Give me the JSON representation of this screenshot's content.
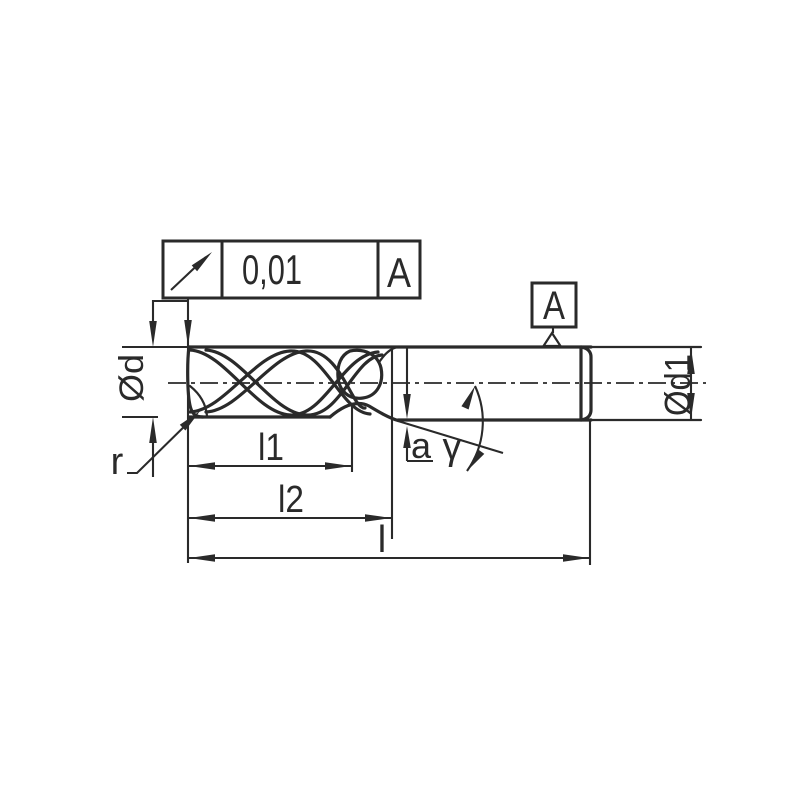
{
  "drawing": {
    "background": "#ffffff",
    "line_color": "#2a2a2a",
    "tolerance_frame": {
      "symbol_icon": "circular-runout-arrow-icon",
      "value": "0,01",
      "datum_ref": "A"
    },
    "datum_flag": {
      "label": "A",
      "anchor_icon": "datum-triangle-icon"
    },
    "labels": {
      "cutting_diameter": "Ød",
      "shank_diameter": "Ød1",
      "flute_length": "l1",
      "length_to_neck": "l2",
      "overall_length": "l",
      "corner_radius": "r",
      "neck_offset": "a",
      "neck_angle": "γ"
    }
  }
}
